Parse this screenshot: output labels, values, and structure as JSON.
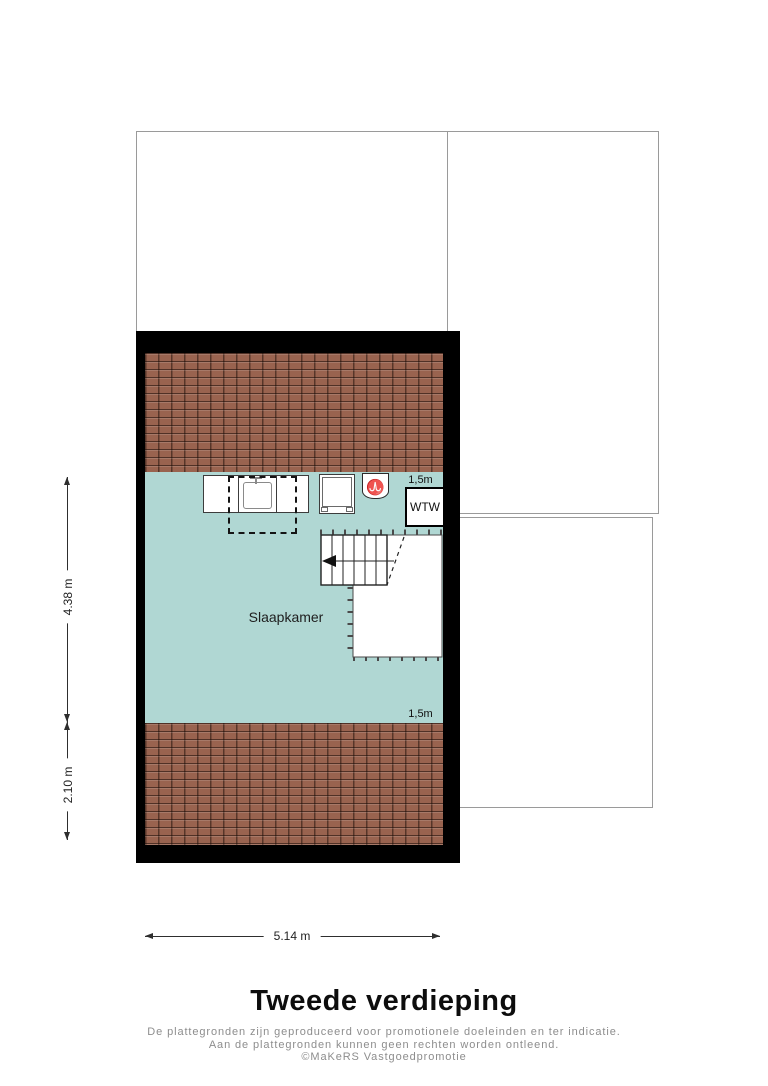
{
  "floorplan": {
    "room": {
      "label": "Slaapkamer"
    },
    "wtw_unit": {
      "label": "WTW"
    },
    "height_lines": {
      "top": "1,5m",
      "bottom": "1,5m"
    },
    "icons": {
      "ventilation_glyph": "♈"
    }
  },
  "dimensions": {
    "left_upper": "4.38 m",
    "left_lower": "2.10 m",
    "bottom": "5.14 m"
  },
  "footer": {
    "title": "Tweede verdieping",
    "disclaimer": [
      "De plattegronden zijn geproduceerd voor promotionele doeleinden en ter indicatie.",
      "Aan de plattegronden kunnen geen rechten worden ontleend.",
      "©MaKeRS Vastgoedpromotie"
    ]
  },
  "colors": {
    "roof_tile": "#99634f",
    "room_fill": "#b0d7d3",
    "wall": "#000000",
    "outline": "#9a9a9a"
  }
}
